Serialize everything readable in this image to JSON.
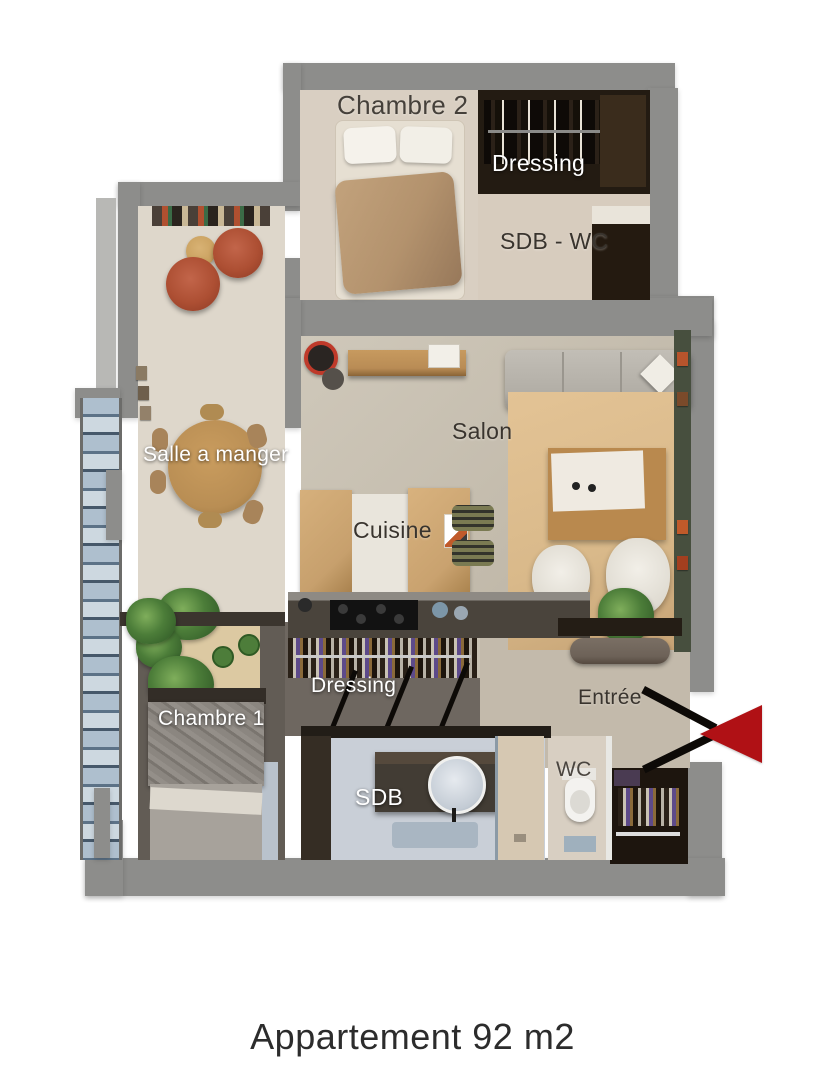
{
  "title": "Plan 3D appartement",
  "rooms": [
    {
      "id": "chambre-2",
      "label": "Chambre 2",
      "tone": "dark"
    },
    {
      "id": "dressing-haut",
      "label": "Dressing",
      "tone": "light"
    },
    {
      "id": "sdb-wc",
      "label": "SDB - WC",
      "tone": "dark"
    },
    {
      "id": "salle-a-manger",
      "label": "Salle a manger",
      "tone": "light"
    },
    {
      "id": "salon",
      "label": "Salon",
      "tone": "dark"
    },
    {
      "id": "cuisine",
      "label": "Cuisine",
      "tone": "dark"
    },
    {
      "id": "dressing-bas",
      "label": "Dressing",
      "tone": "light"
    },
    {
      "id": "chambre-1",
      "label": "Chambre 1",
      "tone": "light"
    },
    {
      "id": "entree",
      "label": "Entrée",
      "tone": "dark"
    },
    {
      "id": "sdb",
      "label": "SDB",
      "tone": "light"
    },
    {
      "id": "wc",
      "label": "WC",
      "tone": "dark"
    }
  ],
  "caption": "Appartement 92 m2",
  "colors": {
    "arrow_red": "#b01115",
    "wall_gray": "#8d8d8b",
    "label_light": "#ffffff",
    "label_dark": "#39342e",
    "accent_wall_green": "#474f3e",
    "terracotta_chair": "#ad4f33"
  }
}
